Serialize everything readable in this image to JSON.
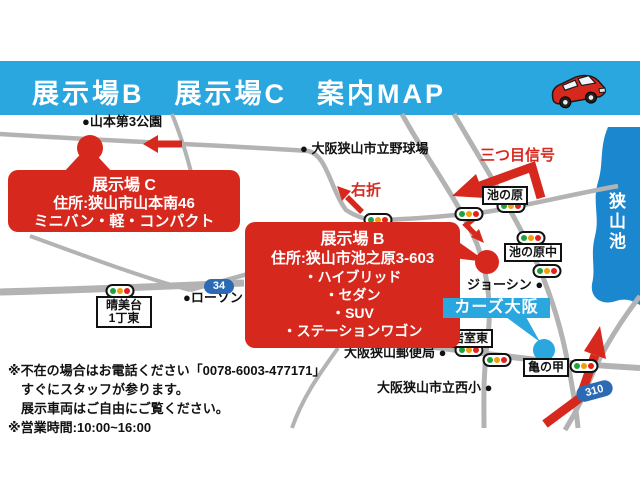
{
  "header": {
    "title": "展示場B　展示場C　案内MAP"
  },
  "callouts": {
    "site_c": {
      "name": "展示場 C",
      "address": "住所:狭山市山本南46",
      "vehicles": "ミニバン・軽・コンパクト"
    },
    "site_b": {
      "name": "展示場 B",
      "address": "住所:狭山市池之原3-603",
      "items": [
        "・ハイブリッド",
        "・セダン",
        "・SUV",
        "・ステーションワゴン"
      ]
    },
    "cars_osaka": "カーズ大阪"
  },
  "labels": {
    "yamamoto_park": "●山本第3公園",
    "ballpark": "● 大阪狭山市立野球場",
    "third_signal": "三つ目信号",
    "turn_right": "右折",
    "ikenohara": "池の原",
    "ikenohara_naka": "池の原中",
    "lake": "狭山池",
    "joshin": "ジョーシン ●",
    "iwamuro": "岩室東",
    "post_office": "大阪狭山郵便局 ●",
    "kamenoko": "亀の甲",
    "nishi_elementary": "大阪狭山市立西小 ●",
    "harumidai_1": "晴美台",
    "harumidai_2": "1丁東",
    "lawson": "●ローソン"
  },
  "badges": {
    "r34": "34",
    "r310": "310"
  },
  "notes": [
    "※不在の場合はお電話ください「0078-6003-477171」",
    "すぐにスタッフが参ります。",
    "展示車両はご自由にご覧ください。",
    "※営業時間:10:00~16:00"
  ],
  "colors": {
    "header_blue": "#2BA7E0",
    "accent_red": "#D7281E",
    "lake_blue": "#1B87CE",
    "badge_blue": "#2B6BB5",
    "road_gray": "#B3B3B3"
  }
}
